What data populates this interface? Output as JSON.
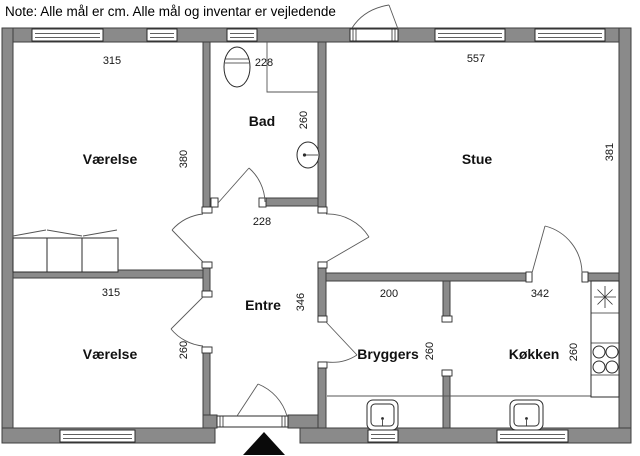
{
  "note": "Note: Alle mål er cm. Alle mål og inventar er vejledende",
  "colors": {
    "wall_fill": "#8a8a8a",
    "wall_outline": "#3f3f3f",
    "background": "#ffffff",
    "text": "#111111",
    "entrance_marker": "#000000"
  },
  "rooms": {
    "vaerelse1": {
      "name": "Værelse",
      "width": "315",
      "height": "380"
    },
    "bad": {
      "name": "Bad",
      "width": "228",
      "height": "260"
    },
    "stue": {
      "name": "Stue",
      "width": "557",
      "height": "381"
    },
    "entre": {
      "name": "Entre",
      "width": "228",
      "height": "346"
    },
    "vaerelse2": {
      "name": "Værelse",
      "width": "315",
      "height": "260"
    },
    "bryggers": {
      "name": "Bryggers",
      "width": "200",
      "height": "260"
    },
    "koekken": {
      "name": "Køkken",
      "width": "342",
      "height": "260"
    }
  }
}
